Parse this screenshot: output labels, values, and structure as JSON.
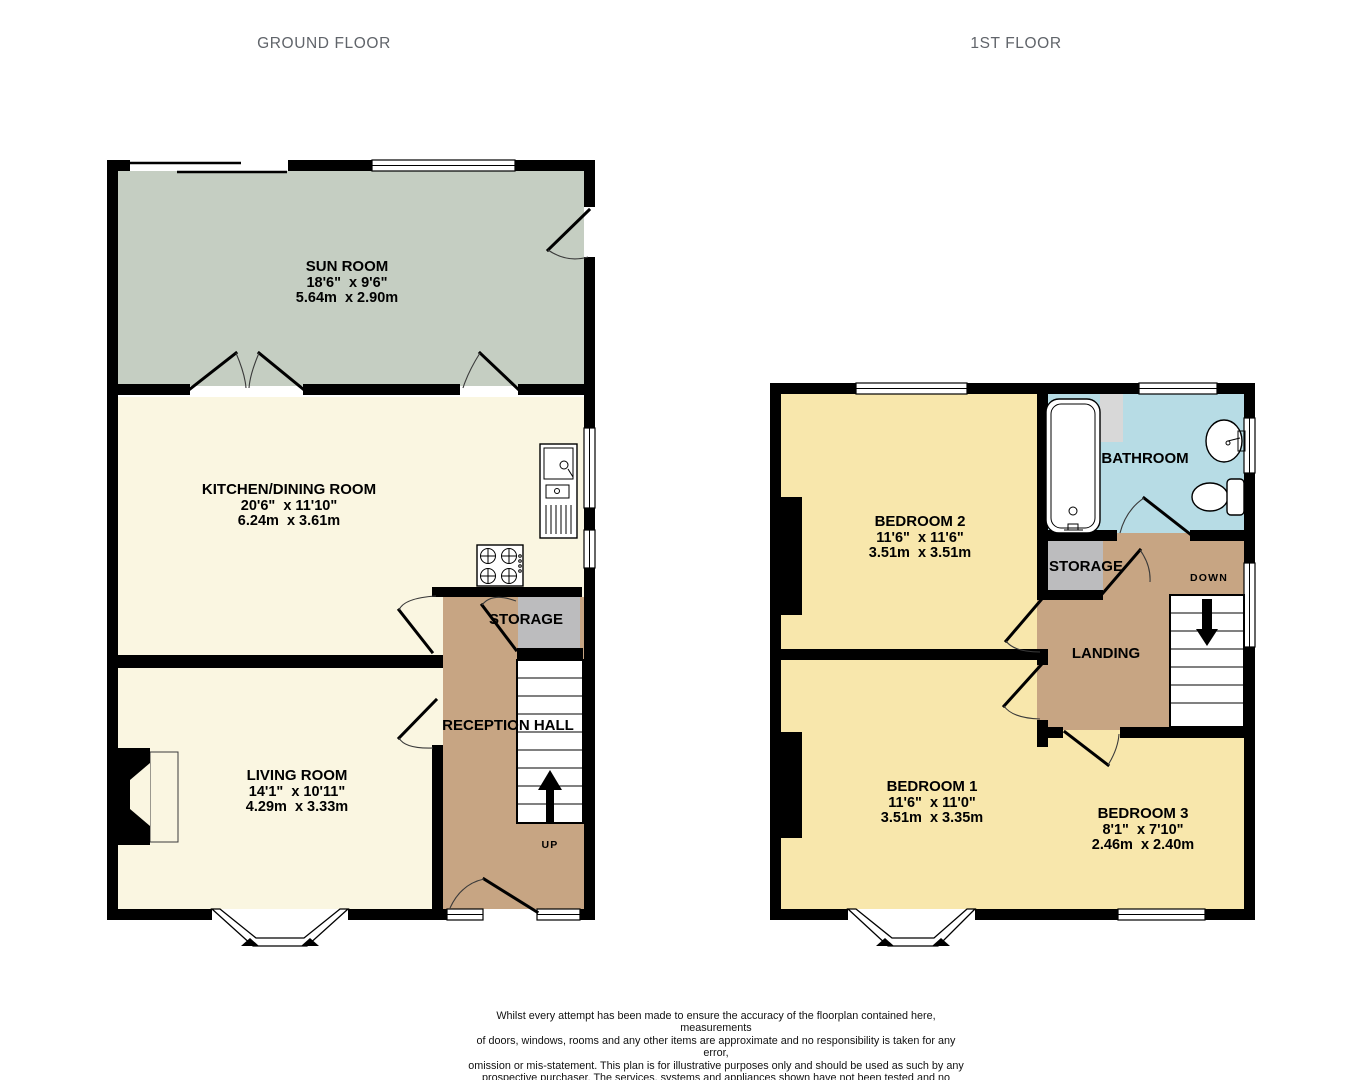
{
  "titles": {
    "ground": "GROUND FLOOR",
    "first": "1ST FLOOR"
  },
  "colors": {
    "sun_room_green": "#c5cec2",
    "cream": "#faf6e1",
    "bedroom_yellow": "#f8e7ac",
    "hall_tan": "#c7a583",
    "storage_gray": "#bcbcbe",
    "bathroom_blue": "#b7dce5",
    "alcove_gray": "#d8d8d8",
    "wall_black": "#000000",
    "title_gray": "#60646A"
  },
  "ground_floor": {
    "sun_room": {
      "name": "SUN ROOM",
      "imperial": "18'6\"  x 9'6\"",
      "metric": "5.64m  x 2.90m"
    },
    "kitchen": {
      "name": "KITCHEN/DINING ROOM",
      "imperial": "20'6\"  x 11'10\"",
      "metric": "6.24m  x 3.61m"
    },
    "living_room": {
      "name": "LIVING ROOM",
      "imperial": "14'1\"  x 10'11\"",
      "metric": "4.29m  x 3.33m"
    },
    "storage": {
      "name": "STORAGE"
    },
    "reception_hall": {
      "name": "RECEPTION HALL"
    },
    "stairs": {
      "label": "UP"
    }
  },
  "first_floor": {
    "bedroom2": {
      "name": "BEDROOM 2",
      "imperial": "11'6\"  x 11'6\"",
      "metric": "3.51m  x 3.51m"
    },
    "bedroom1": {
      "name": "BEDROOM 1",
      "imperial": "11'6\"  x 11'0\"",
      "metric": "3.51m  x 3.35m"
    },
    "bedroom3": {
      "name": "BEDROOM 3",
      "imperial": "8'1\"  x 7'10\"",
      "metric": "2.46m  x 2.40m"
    },
    "bathroom": {
      "name": "BATHROOM"
    },
    "storage": {
      "name": "STORAGE"
    },
    "landing": {
      "name": "LANDING"
    },
    "stairs": {
      "label": "DOWN"
    }
  },
  "disclaimer": {
    "lines": [
      "Whilst every attempt has been made to ensure the accuracy of the floorplan contained here, measurements",
      "of doors, windows, rooms and any other items are approximate and no responsibility is taken for any error,",
      "omission or mis-statement. This plan is for illustrative purposes only and should be used as such by any",
      "prospective purchaser. The services, systems and appliances shown have not been tested and no guarantee",
      "as to their operability or efficiency can be given.",
      "Made with Metropix ©2025"
    ]
  }
}
